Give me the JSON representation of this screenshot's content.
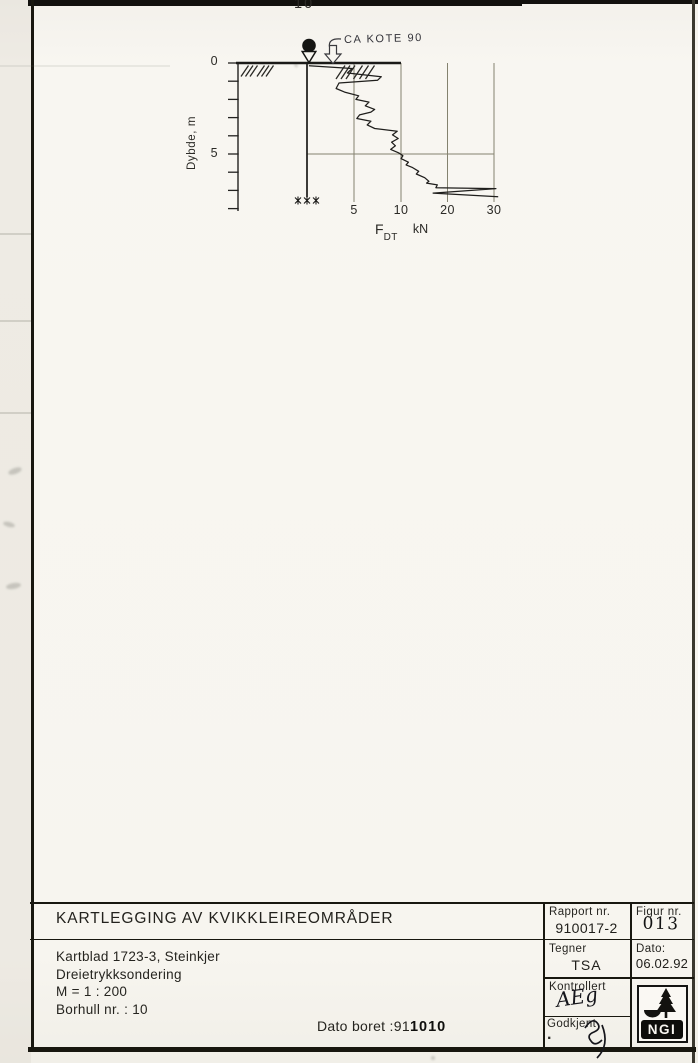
{
  "page": {
    "borehole_number": "10"
  },
  "chart": {
    "annotation": "CA KOTE 90",
    "xlabel_f": "F",
    "xlabel_sub": "DT",
    "xlabel_unit": "kN"
  },
  "chart_data": {
    "type": "line",
    "title": "Dreietrykksondering, borhull 10",
    "xlabel": "F_DT (kN)",
    "ylabel": "Dybde, m",
    "x_ticks": [
      5,
      10,
      20,
      30
    ],
    "y_ticks": [
      0,
      5
    ],
    "ylim": [
      0,
      8
    ],
    "x_scale_note": "segmented axis: 0-10 linear, 10-30 compressed to half spacing",
    "annotation": "CA KOTE 90",
    "grid": true,
    "points_format": [
      "depth_m",
      "F_kN"
    ],
    "series": [
      {
        "name": "F_DT",
        "points": [
          [
            0.15,
            0.2
          ],
          [
            0.3,
            4.8
          ],
          [
            0.55,
            4.3
          ],
          [
            0.75,
            7.9
          ],
          [
            0.95,
            7.5
          ],
          [
            1.1,
            3.4
          ],
          [
            1.4,
            3.1
          ],
          [
            1.6,
            4.0
          ],
          [
            1.8,
            5.5
          ],
          [
            2.0,
            5.2
          ],
          [
            2.15,
            6.6
          ],
          [
            2.35,
            6.2
          ],
          [
            2.55,
            7.2
          ],
          [
            2.7,
            6.8
          ],
          [
            2.85,
            5.6
          ],
          [
            3.05,
            5.3
          ],
          [
            3.2,
            6.8
          ],
          [
            3.4,
            6.4
          ],
          [
            3.6,
            7.2
          ],
          [
            3.75,
            9.6
          ],
          [
            3.95,
            9.1
          ],
          [
            4.15,
            9.7
          ],
          [
            4.35,
            9.0
          ],
          [
            4.55,
            9.4
          ],
          [
            4.75,
            8.9
          ],
          [
            4.95,
            9.8
          ],
          [
            5.1,
            10.4
          ],
          [
            5.25,
            10.0
          ],
          [
            5.45,
            11.6
          ],
          [
            5.6,
            11.1
          ],
          [
            5.75,
            12.5
          ],
          [
            5.95,
            13.8
          ],
          [
            6.1,
            13.3
          ],
          [
            6.3,
            15.1
          ],
          [
            6.5,
            16.0
          ],
          [
            6.6,
            15.5
          ],
          [
            6.7,
            17.8
          ],
          [
            6.85,
            17.5
          ],
          [
            6.9,
            30.4
          ],
          [
            7.15,
            16.9
          ],
          [
            7.35,
            30.9
          ]
        ]
      }
    ]
  },
  "title_block": {
    "title": "KARTLEGGING AV KVIKKLEIREOMRÅDER",
    "info_lines": [
      "Kartblad 1723-3, Steinkjer",
      "Dreietrykksondering",
      "M = 1 : 200",
      "Borhull nr. : 10"
    ],
    "dato_boret_label": "Dato boret :91",
    "dato_boret_value": "1010",
    "rapport_label": "Rapport nr.",
    "rapport_value": "910017-2",
    "figur_label": "Figur nr.",
    "figur_value": "013",
    "tegner_label": "Tegner",
    "tegner_value": "TSA",
    "dato_label": "Dato:",
    "dato_value": "06.02.92",
    "kontrollert_label": "Kontrollert",
    "kontrollert_value": "AEg",
    "godkjent_label": "Godkjent",
    "godkjent_dot": ".",
    "logo_text": "NGI"
  }
}
